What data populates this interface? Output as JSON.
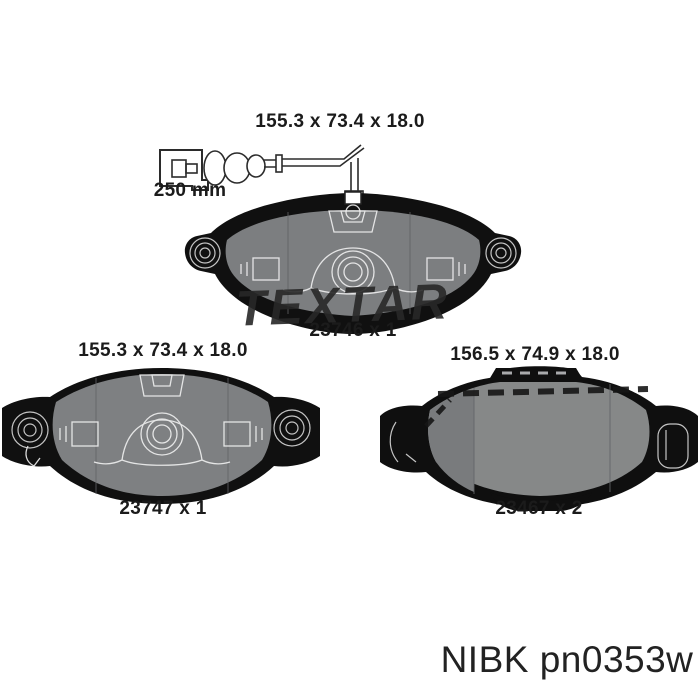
{
  "page": {
    "background": "#ffffff"
  },
  "sensor": {
    "length_label": "250 mm"
  },
  "watermark": {
    "text": "TEXTAR"
  },
  "pads": [
    {
      "position": "top",
      "dimensions": "155.3 x 73.4 x 18.0",
      "label": "23746 x 1"
    },
    {
      "position": "bottom-left",
      "dimensions": "155.3 x 73.4 x 18.0",
      "label": "23747 x 1"
    },
    {
      "position": "bottom-right",
      "dimensions": "156.5 x 74.9 x 18.0",
      "label": "23467 x 2"
    }
  ],
  "brand_footer": {
    "text": "NIBK pn0353w",
    "brand": "NIBK",
    "part_number": "pn0353w"
  },
  "colors": {
    "pad_face": "#7e8082",
    "pad_face_light": "#868888",
    "pad_dark": "#101010",
    "detail_line": "#f0f0f0",
    "text": "#1b1b1b",
    "background": "#ffffff"
  }
}
